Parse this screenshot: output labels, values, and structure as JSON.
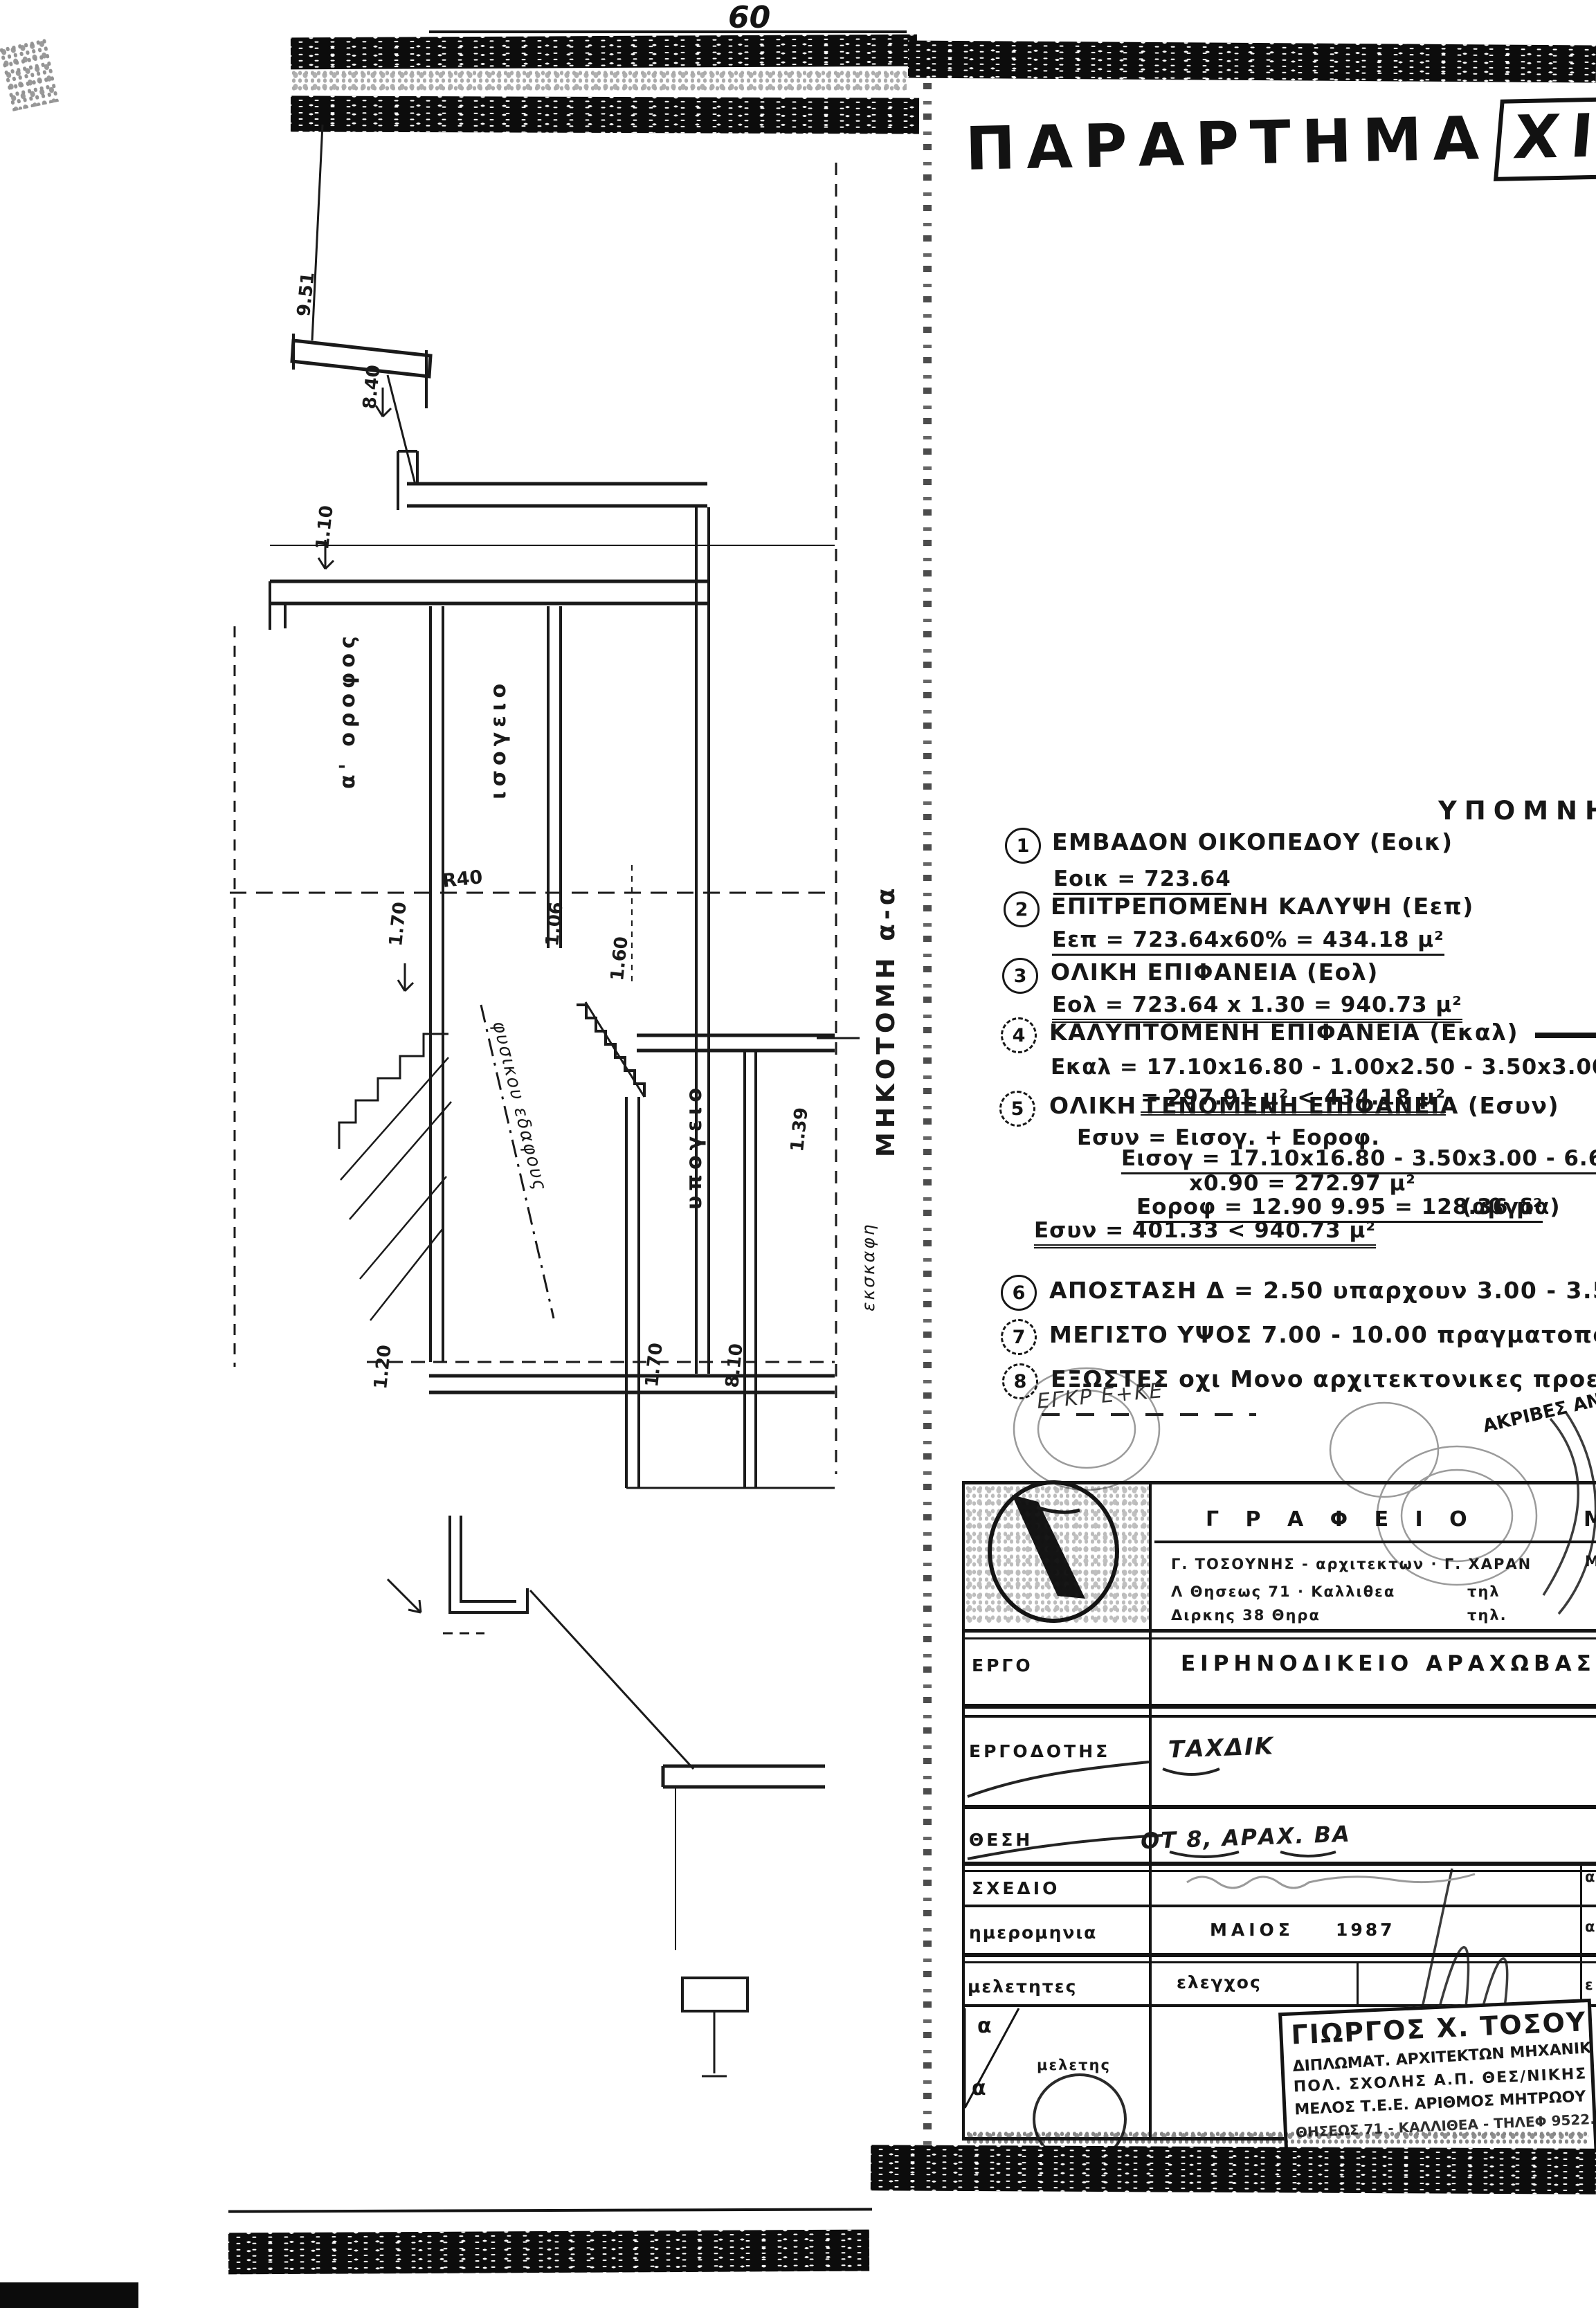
{
  "meta": {
    "ink_color": "#141414",
    "paper_color": "#ffffff"
  },
  "page": {
    "page_number": "60",
    "title_word": "ΠΑΡΑΡΤΗΜΑ",
    "title_num": "XI"
  },
  "drawing": {
    "section_label": "ΜΗΚΟΤΟΜΗ  α-α",
    "excavation_label": "εκσκαφη",
    "ground_line_label": "φυσικου εδαφους",
    "level_line_label": "R40",
    "floors": {
      "upper": "α' οροφος",
      "ground": "ισογειο",
      "basement": "υπογειο"
    },
    "dims": {
      "d951": "9.51",
      "d840": "8.40",
      "d110": "1.10",
      "d170a": "1.70",
      "d106": "1.06",
      "d160": "1.60",
      "d139": "1.39",
      "d120": "1.20",
      "d170b": "1.70",
      "d810": "8.10"
    }
  },
  "legend": {
    "heading": "ΥΠΟΜΝΗΜΑ",
    "items": [
      {
        "num": "1",
        "title": "ΕΜΒΑΔΟΝ  ΟΙΚΟΠΕΔΟΥ  (Εοικ)",
        "lines": [
          "Εοικ = 723.64"
        ]
      },
      {
        "num": "2",
        "title": "ΕΠΙΤΡΕΠΟΜΕΝΗ  ΚΑΛΥΨΗ  (Εεπ)",
        "lines": [
          "Εεπ = 723.64x60% = 434.18  μ²"
        ]
      },
      {
        "num": "3",
        "title": "ΟΛΙΚΗ  ΕΠΙΦΑΝΕΙΑ  (Εολ)",
        "lines": [
          "Εολ = 723.64 x 1.30 = 940.73 μ²"
        ]
      },
      {
        "num": "4",
        "title": "ΚΑΛΥΠΤΟΜΕΝΗ  ΕΠΙΦΑΝΕΙΑ  (Εκαλ)",
        "lines": [
          "Εκαλ = 17.10x16.80 - 1.00x2.50 - 3.50x3.00 + 0.90x9",
          "= 297.91 μ² <  434.18 μ²"
        ]
      },
      {
        "num": "5",
        "title": "ΟΛΙΚΗ  ΓΕΝΟΜΕΝΗ  ΕΠΙΦΑΝΕΙΑ  (Εσυν)",
        "lines": [
          "Εσυν = Εισογ. + Εοροφ.",
          "Εισογ = 17.10x16.80 - 3.50x3.00 - 6.60x1.00 + (",
          "x0.90 = 272.97 μ²",
          "Εοροφ = 12.90  9.95 = 128.36 μ²",
          "(αβγδα)",
          "Εσυν = 401.33 < 940.73 μ²"
        ]
      },
      {
        "num": "6",
        "title": "ΑΠΟΣΤΑΣΗ  Δ = 2.50   υπαρχουν  3.00 - 3.50 - 4.20",
        "lines": []
      },
      {
        "num": "7",
        "title": "ΜΕΓΙΣΤΟ  ΥΨΟΣ  7.00 - 10.00   πραγματοποιουμ",
        "lines": []
      },
      {
        "num": "8",
        "title": "ΕΞΩΣΤΕΣ   οχι   Μονο  αρχιτεκτονικες  προεξοχ",
        "lines": []
      }
    ],
    "approval_note": "ΕΓΚΡ  Ε+ΚΕ",
    "copy_note": "ΑΚΡΙΒΕΣ ΑΝΤΙΓΡ"
  },
  "titleblock": {
    "office": {
      "label": "Γ Ρ Α Φ Ε Ι Ο",
      "label_cut": "Μ",
      "names": "Γ. ΤΟΣΟΥΝΗΣ - αρχιτεκτων  ·  Γ. ΧΑΡΑΝ",
      "addr1": "Λ Θησεως  71  · Καλλιθεα",
      "tel1": "τηλ",
      "addr2": "Διρκης   38   Θηρα",
      "tel2": "τηλ."
    },
    "rows": [
      {
        "label": "ΕΡΓΟ",
        "value": "ΕΙΡΗΝΟΔΙΚΕΙΟ   ΑΡΑΧΩΒΑΣ"
      },
      {
        "label": "ΕΡΓΟΔΟΤΗΣ",
        "value": "ΤΑΧΔΙΚ"
      },
      {
        "label": "ΘΕΣΗ",
        "value": "ΟΤ 8,  ΑΡΑΧ. ΒΑ"
      },
      {
        "label": "ΣΧΕΔΙΟ",
        "value": ""
      },
      {
        "label": "ημερομηνια",
        "value": "ΜΑΙΟΣ",
        "value2": "1987"
      },
      {
        "label": "μελετητες",
        "value": "ελεγχος"
      }
    ],
    "study_label": "μελετης",
    "triangle_letters": [
      "α",
      "α"
    ],
    "edge_letters": [
      "Μ",
      "α",
      "α",
      "ε"
    ],
    "stamp": {
      "line1": "ΓΙΩΡΓΟΣ Χ. ΤΟΣΟΥΝΗΣ",
      "line2": "ΔΙΠΛΩΜΑΤ. ΑΡΧΙΤΕΚΤΩΝ ΜΗΧΑΝΙΚΟΣ",
      "line3": "ΠΟΛ. ΣΧΟΛΗΣ  Α.Π. ΘΕΣ/ΝΙΚΗΣ",
      "line4": "ΜΕΛΟΣ Τ.Ε.Ε. ΑΡΙΘΜΟΣ ΜΗΤΡΩΟΥ 20674",
      "line5": "ΘΗΣΕΩΣ 71 - ΚΑΛΛΙΘΕΑ - ΤΗΛΕΦ 9522.17"
    }
  }
}
